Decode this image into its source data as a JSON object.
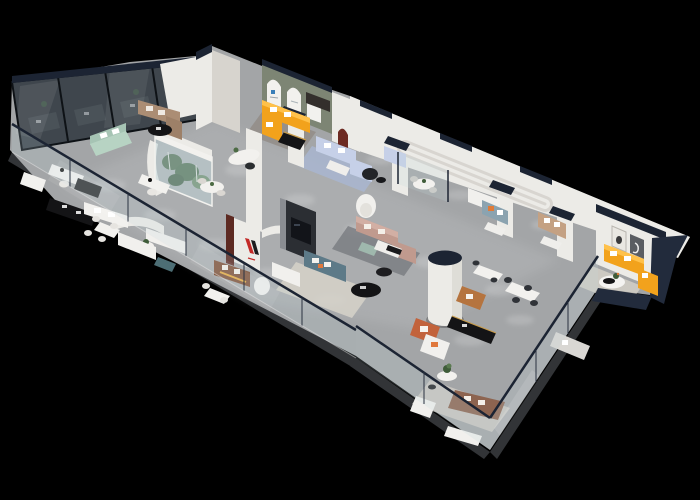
{
  "meta": {
    "description": "Isometric 3D cutaway render (dollhouse view) of a modern furniture showroom floor, viewed from above on a pure black background",
    "view": "aerial oblique, long hall running lower-left to upper-right",
    "legible_text": "none (logos and picture-frame text are too small to read)"
  },
  "palette": {
    "background": "#000000",
    "floor": "#a3a5a7",
    "floor_bright": "#c7c9cb",
    "slab_edge": "#323437",
    "wall": "#ecebe7",
    "wall_shade": "#d7d4ce",
    "navy": "#1c2433",
    "navy_wall": "#222b3c",
    "glass_smoked": "#57646d",
    "glass_interior": "#26292c",
    "glass_light": "#c2d6dc",
    "sage": "#7d8574",
    "arch_white": "#f2f1ee",
    "niche_red": "#6d2a22",
    "maroon_slats": "#5d2a22",
    "charcoal": "#2b2e33",
    "screen_black": "#121419",
    "logo_red": "#c32a28",
    "logo_black": "#1c1c1e",
    "logo_blue": "#3a7fb8",
    "orange_sofa": "#f2a21c",
    "orange_highlight": "#ffc14a",
    "mint_sofa": "#b7d3c3",
    "tan_sofa": "#ab8d74",
    "slate_sofa": "#5d7a88",
    "mauve_sofa": "#c09a8e",
    "periwinkle_sofa": "#c6d0e8",
    "blue_gray_sofa": "#8ba3b0",
    "camel_sofa": "#c4a183",
    "brown_leather": "#7c4b30",
    "taupe_leather": "#8d6450",
    "caramel_chair": "#b5743f",
    "terracotta_chair": "#c2633c",
    "white_furniture": "#f2f1ee",
    "black_furniture": "#141416",
    "gold_trim": "#c79b4b",
    "yellow_glow": "#f3b43c",
    "plant_green": "#3f5c39",
    "plant_green_light": "#5a7a50",
    "rug_cream": "#d6d2c9",
    "rug_dark": "#787b80",
    "rug_blue": "#a9b6d2",
    "rug_warm": "#8e8880",
    "seafoam": "#9fb8ad",
    "teal_ottoman": "#4d6e75",
    "art_frame_dark": "#5a5d62"
  },
  "zones": [
    "smoked-glass-private-offices",
    "mint-sofa-vignette",
    "tan-sectional-vignette",
    "planted-glass-atrium",
    "office-desk-area",
    "curved-pod-lounges",
    "brand-logo-wall-with-leather-sofa",
    "tv-wall-slate-sofa-lounge",
    "mauve-sectional-lounge",
    "arched-gallery-room-orange-sectional",
    "periwinkle-sectional-room",
    "column-and-armchair-corner",
    "dining-display-tables",
    "glass-walled-front-showroom",
    "orange-sofa-end-room",
    "glass-balustrade-front-edge"
  ]
}
